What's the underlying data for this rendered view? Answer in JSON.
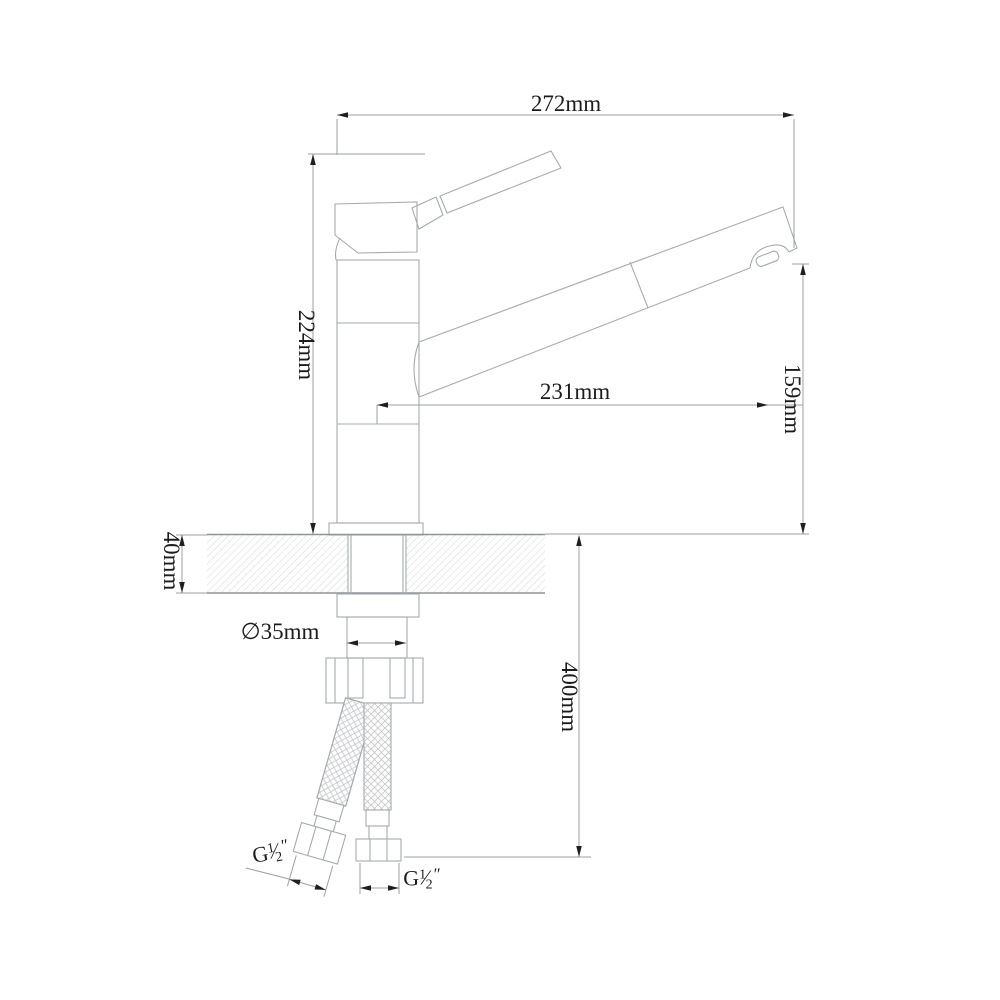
{
  "page": {
    "background": "#ffffff",
    "subject": "Technical line drawing of a single-lever kitchen faucet, side elevation with installation dimensions"
  },
  "dimensions": {
    "overall_width": "272mm",
    "overall_height": "224mm",
    "spout_reach": "231mm",
    "outlet_height": "159mm",
    "deck_thickness": "40mm",
    "hole_diameter": "∅35mm",
    "hose_length": "400mm"
  },
  "threads": {
    "left": {
      "prefix": "G",
      "numerator": "1",
      "slash": "⁄",
      "denominator": "2",
      "unit": "″"
    },
    "right": {
      "prefix": "G",
      "numerator": "1",
      "slash": "⁄",
      "denominator": "2",
      "unit": "″"
    }
  },
  "colors": {
    "background": "#ffffff",
    "object_line": "#a6abae",
    "dimension_line": "#9aa0a3",
    "hatch_line": "#d6d8d9",
    "braid_line": "#c6c9cb",
    "arrow_and_text": "#1c1c1c"
  }
}
